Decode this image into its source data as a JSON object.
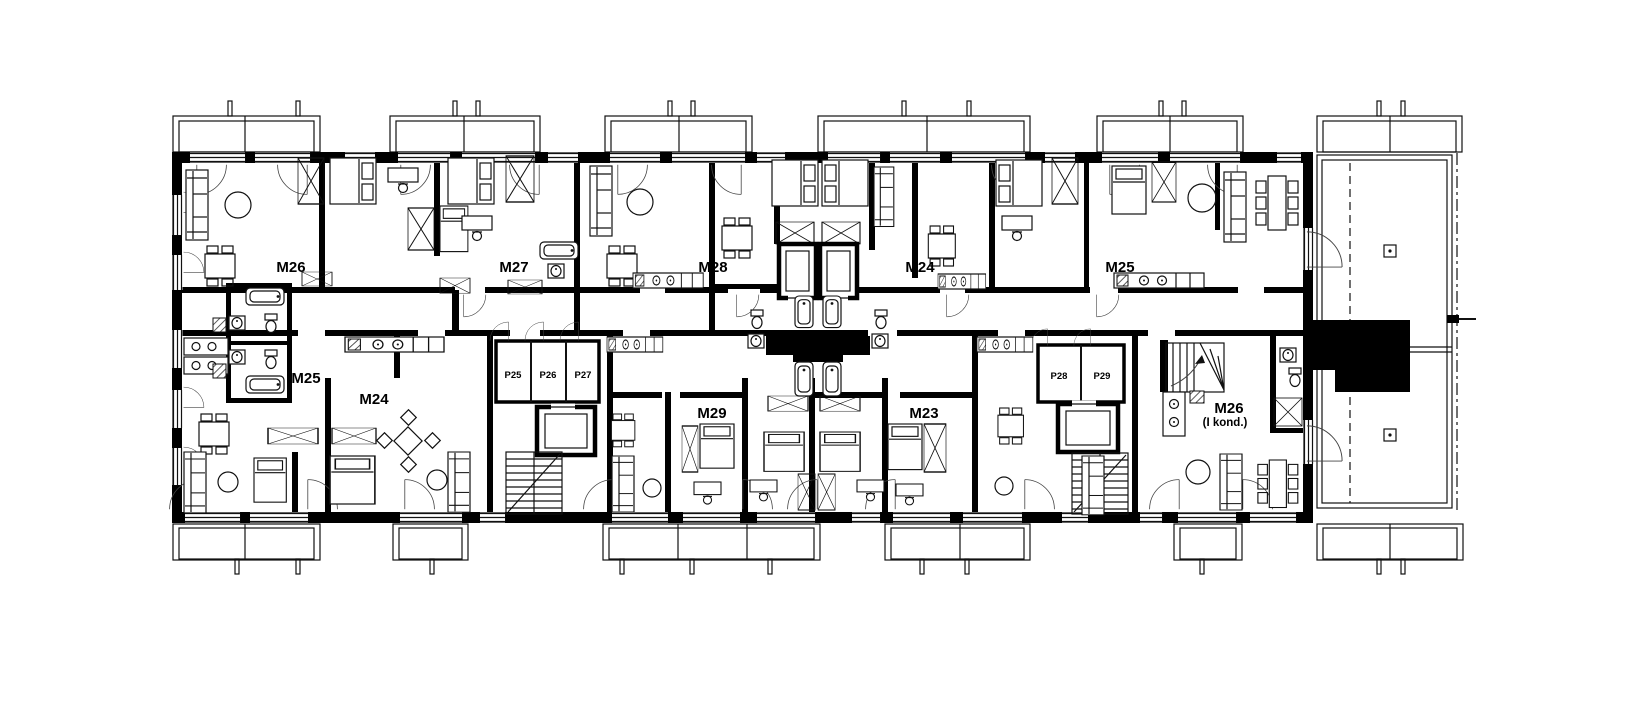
{
  "plan": {
    "apartments": {
      "top": [
        {
          "label": "M26"
        },
        {
          "label": "M27"
        },
        {
          "label": "M28"
        },
        {
          "label": "M24"
        },
        {
          "label": "M25"
        }
      ],
      "bottom": [
        {
          "label": "M25"
        },
        {
          "label": "M24"
        },
        {
          "label": "M29"
        },
        {
          "label": "M23"
        },
        {
          "label": "M26",
          "sublabel": "(I kond.)"
        }
      ]
    },
    "storage_rooms": [
      {
        "label": "P25"
      },
      {
        "label": "P26"
      },
      {
        "label": "P27"
      },
      {
        "label": "P28"
      },
      {
        "label": "P29"
      }
    ],
    "colors": {
      "background": "#ffffff",
      "walls": "#000000",
      "lines": "#111111"
    }
  }
}
